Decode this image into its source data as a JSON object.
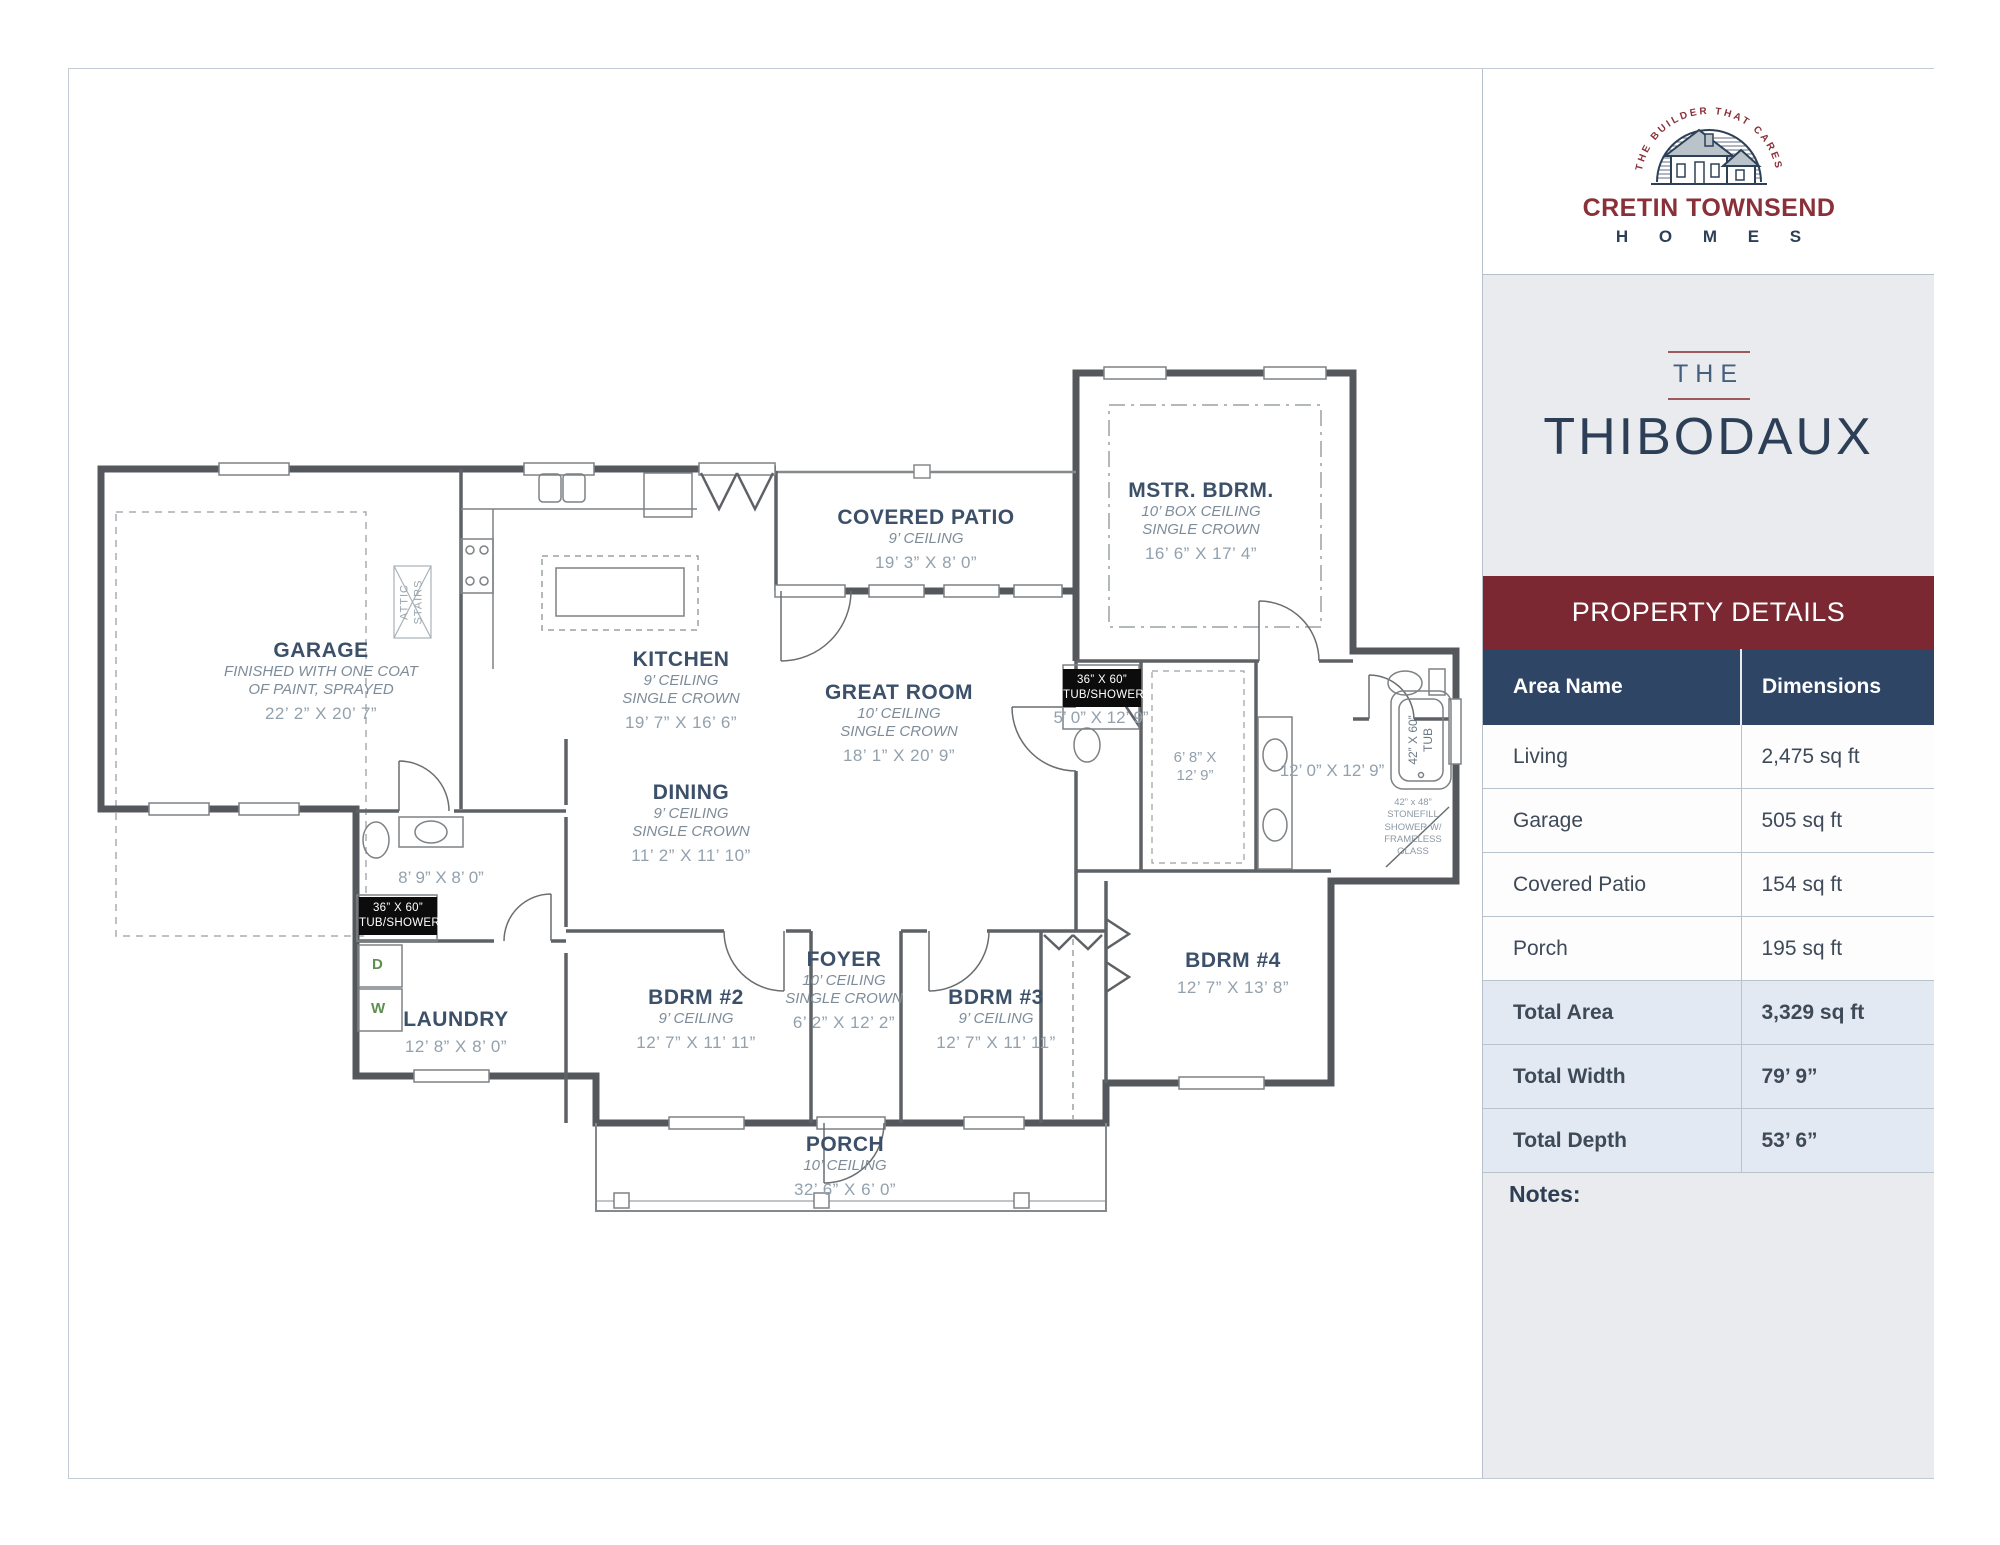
{
  "brand": {
    "arc_text": "THE BUILDER THAT CARES",
    "name_line1": "CRETIN TOWNSEND",
    "name_line2": "H O M E S"
  },
  "plan_title": {
    "prefix": "THE",
    "name": "THIBODAUX"
  },
  "theme": {
    "maroon": "#7b2832",
    "brand_red": "#8a3038",
    "navy_header": "#2e4565",
    "navy_text": "#2d3f57",
    "panel_bg": "#e9ebee",
    "highlight_row_bg": "#e2e9f2",
    "room_label_color": "#3c5069",
    "dim_text_color": "#93a1ad"
  },
  "property_details": {
    "header": "PROPERTY DETAILS",
    "columns": {
      "area": "Area Name",
      "dimensions": "Dimensions"
    },
    "rows": [
      {
        "area": "Living",
        "dimensions": "2,475 sq ft"
      },
      {
        "area": "Garage",
        "dimensions": "505 sq ft"
      },
      {
        "area": "Covered Patio",
        "dimensions": "154 sq ft"
      },
      {
        "area": "Porch",
        "dimensions": "195 sq ft"
      },
      {
        "area": "Total Area",
        "dimensions": "3,329 sq ft"
      },
      {
        "area": "Total Width",
        "dimensions": "79’ 9”"
      },
      {
        "area": "Total Depth",
        "dimensions": "53’ 6”"
      }
    ],
    "notes_label": "Notes:"
  },
  "floor_plan": {
    "rooms": {
      "garage": {
        "name": "GARAGE",
        "note1": "FINISHED WITH ONE COAT",
        "note2": "OF PAINT, SPRAYED",
        "dims": "22’ 2” X 20’ 7”"
      },
      "kitchen": {
        "name": "KITCHEN",
        "ceiling": "9’ CEILING",
        "crown": "SINGLE CROWN",
        "dims": "19’ 7” X 16’ 6”"
      },
      "covered_patio": {
        "name": "COVERED PATIO",
        "ceiling": "9’ CEILING",
        "dims": "19’ 3” X 8’ 0”"
      },
      "master_bedroom": {
        "name": "MSTR. BDRM.",
        "ceiling": "10’ BOX CEILING",
        "crown": "SINGLE CROWN",
        "dims": "16’ 6” X 17’ 4”"
      },
      "great_room": {
        "name": "GREAT ROOM",
        "ceiling": "10’ CEILING",
        "crown": "SINGLE CROWN",
        "dims": "18’ 1” X 20’ 9”"
      },
      "dining": {
        "name": "DINING",
        "ceiling": "9’ CEILING",
        "crown": "SINGLE CROWN",
        "dims": "11’ 2” X 11’ 10”"
      },
      "foyer": {
        "name": "FOYER",
        "ceiling": "10’ CEILING",
        "crown": "SINGLE CROWN",
        "dims": "6’ 2” X 12’ 2”"
      },
      "laundry": {
        "name": "LAUNDRY",
        "dims": "12’ 8” X 8’ 0”"
      },
      "bedroom2": {
        "name": "BDRM #2",
        "ceiling": "9’ CEILING",
        "dims": "12’ 7” X 11’ 11”"
      },
      "bedroom3": {
        "name": "BDRM #3",
        "ceiling": "9’ CEILING",
        "dims": "12’ 7” X 11’ 11”"
      },
      "bedroom4": {
        "name": "BDRM #4",
        "dims": "12’ 7” X 13’ 8”"
      },
      "porch": {
        "name": "PORCH",
        "ceiling": "10’ CEILING",
        "dims": "32’ 6” X 6’ 0”"
      },
      "bath2": {
        "dims": "8’ 9” X 8’ 0”"
      },
      "master_bath_hall": {
        "dims": "5’ 0” X 12’ 9”"
      },
      "master_closet": {
        "dims_l1": "6’ 8” X",
        "dims_l2": "12’ 9”"
      },
      "master_bath": {
        "dims": "12’ 0” X 12’ 9”"
      }
    },
    "fixtures": {
      "tub_shower_hall": {
        "l1": "36” X 60”",
        "l2": "TUB/SHOWER"
      },
      "tub_shower_master": {
        "l1": "36” X 60”",
        "l2": "TUB/SHOWER"
      },
      "tub": {
        "l1": "42” X 60”",
        "l2": "TUB"
      },
      "stonefill": {
        "l1": "42” x 48”",
        "l2": "STONEFILL",
        "l3": "SHOWER W/",
        "l4": "FRAMELESS",
        "l5": "GLASS"
      },
      "attic": {
        "l1": "ATTIC",
        "l2": "STAIRS"
      },
      "washer": "W",
      "dryer": "D"
    }
  }
}
